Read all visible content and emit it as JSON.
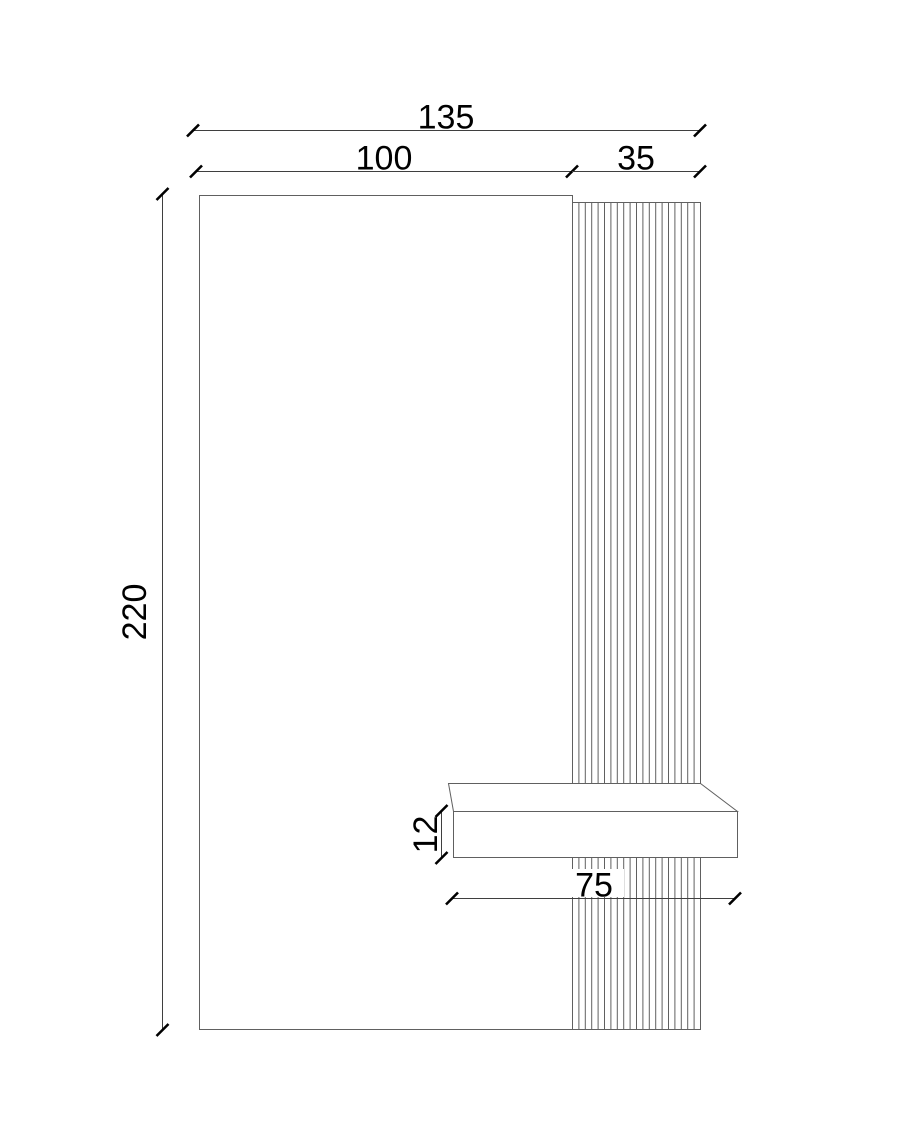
{
  "drawing": {
    "kind": "technical-elevation-drawing",
    "colors": {
      "geometry_line": "#606060",
      "dimension_line": "#3f3f3f",
      "tick": "#000000",
      "text": "#000000",
      "face_fill": "#ffffff",
      "background": "#ffffff"
    },
    "slat_count": 20,
    "dimensions": {
      "total_width": "135",
      "panel_width": "100",
      "slat_width": "35",
      "total_height": "220",
      "shelf_thickness": "12",
      "shelf_length": "75"
    }
  }
}
